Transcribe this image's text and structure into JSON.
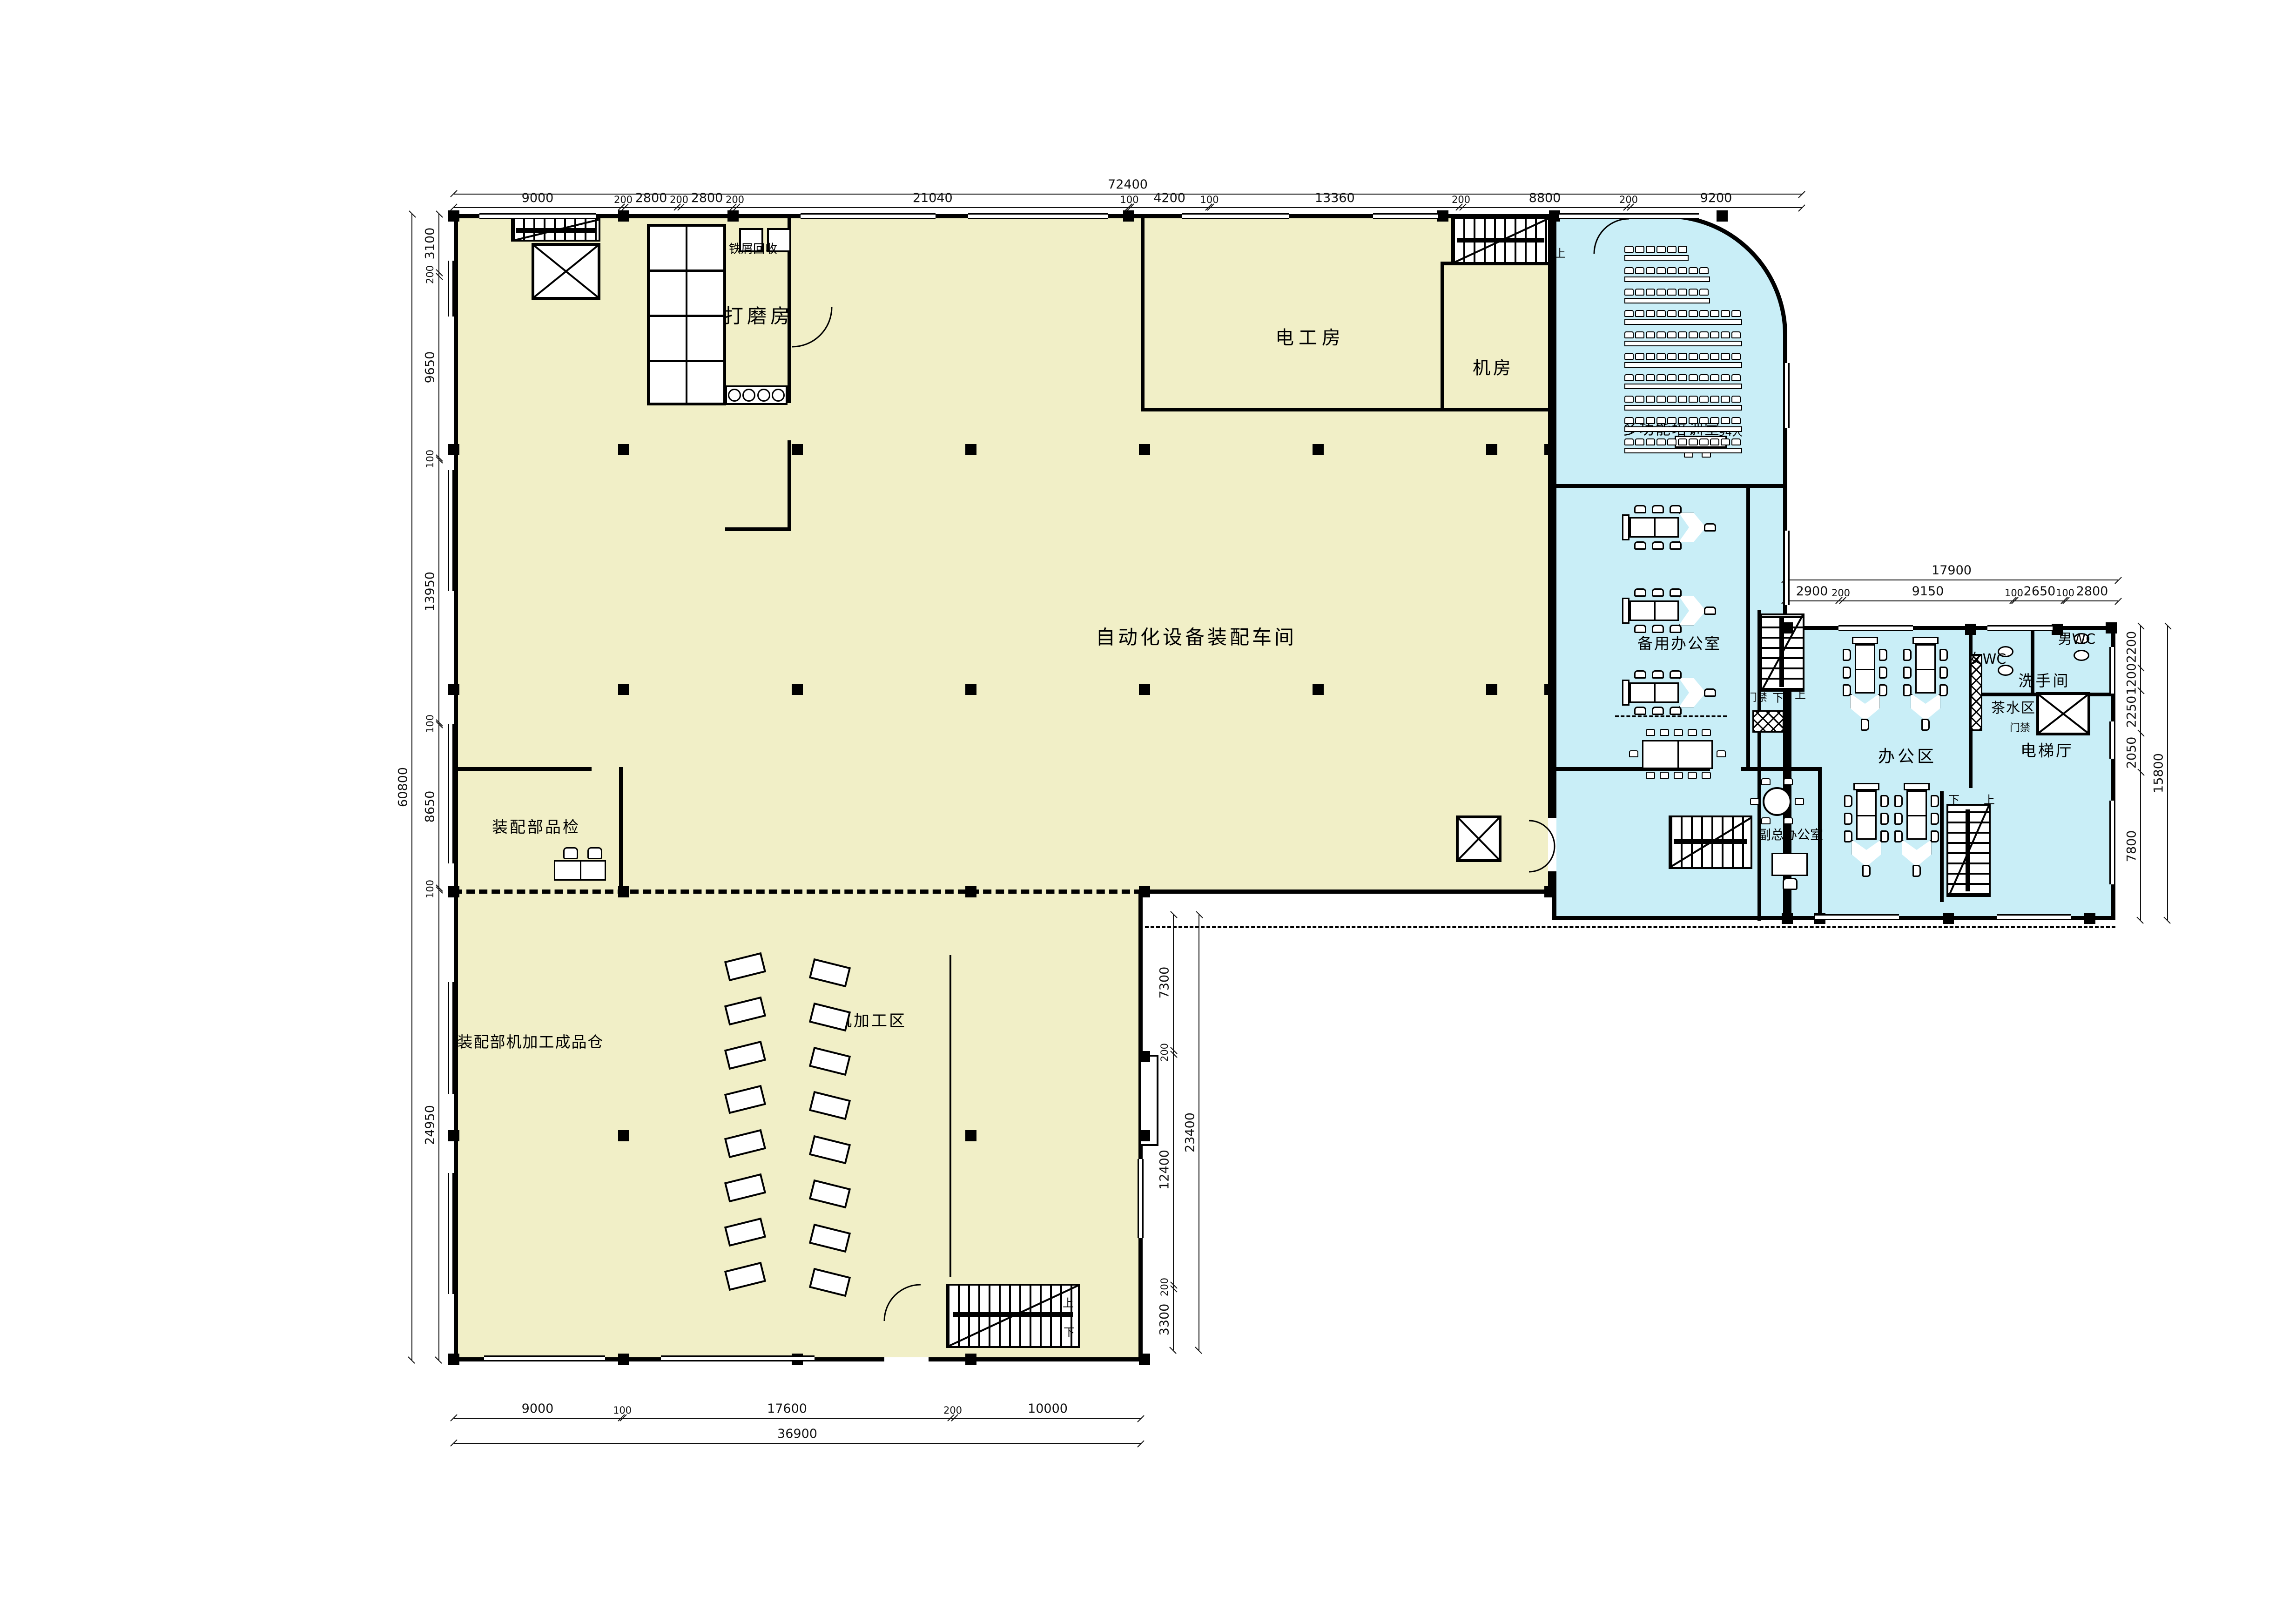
{
  "plan": {
    "rooms": {
      "main_workshop": "自动化设备装配车间",
      "grinding": "打磨房",
      "scrap_recycle": "铁屑回收",
      "electrician": "电工房",
      "machine_room": "机房",
      "training": "多功能培训室",
      "training_capacity": "94人",
      "spare_office": "备用办公室",
      "office_area": "办公区",
      "elevator_hall": "电梯厅",
      "washroom": "洗手间",
      "tea_area": "茶水区",
      "women_wc": "女WC",
      "men_wc": "男WC",
      "deputy_office": "副总办公室",
      "inspection": "装配部品检",
      "warehouse": "装配部机加工成品仓",
      "machining": "机加工区",
      "access_control": "门禁",
      "up": "上",
      "down": "下"
    },
    "dimensions": {
      "top_total": "72400",
      "top": [
        "9000",
        "200",
        "2800",
        "200",
        "2800",
        "200",
        "21040",
        "100",
        "4200",
        "100",
        "13360",
        "200",
        "8800",
        "200",
        "9200"
      ],
      "left_total": "60800",
      "left": [
        "3100",
        "200",
        "9650",
        "100",
        "13950",
        "100",
        "8650",
        "100",
        "24950"
      ],
      "bottom_total": "36900",
      "bottom": [
        "9000",
        "100",
        "17600",
        "200",
        "10000"
      ],
      "mid_total": "23400",
      "mid": [
        "7300",
        "200",
        "12400",
        "200",
        "3300"
      ],
      "east_top_total": "17900",
      "east_top": [
        "2900",
        "200",
        "9150",
        "100",
        "2650",
        "100",
        "2800"
      ],
      "east_right_total": "15800",
      "east_right": [
        "2200",
        "1200",
        "2250",
        "2050",
        "7800"
      ]
    },
    "colors": {
      "workshop_fill": "#F1EFC7",
      "office_fill": "#C9EEF7",
      "wall": "#000000",
      "dim_line": "#111111"
    }
  }
}
